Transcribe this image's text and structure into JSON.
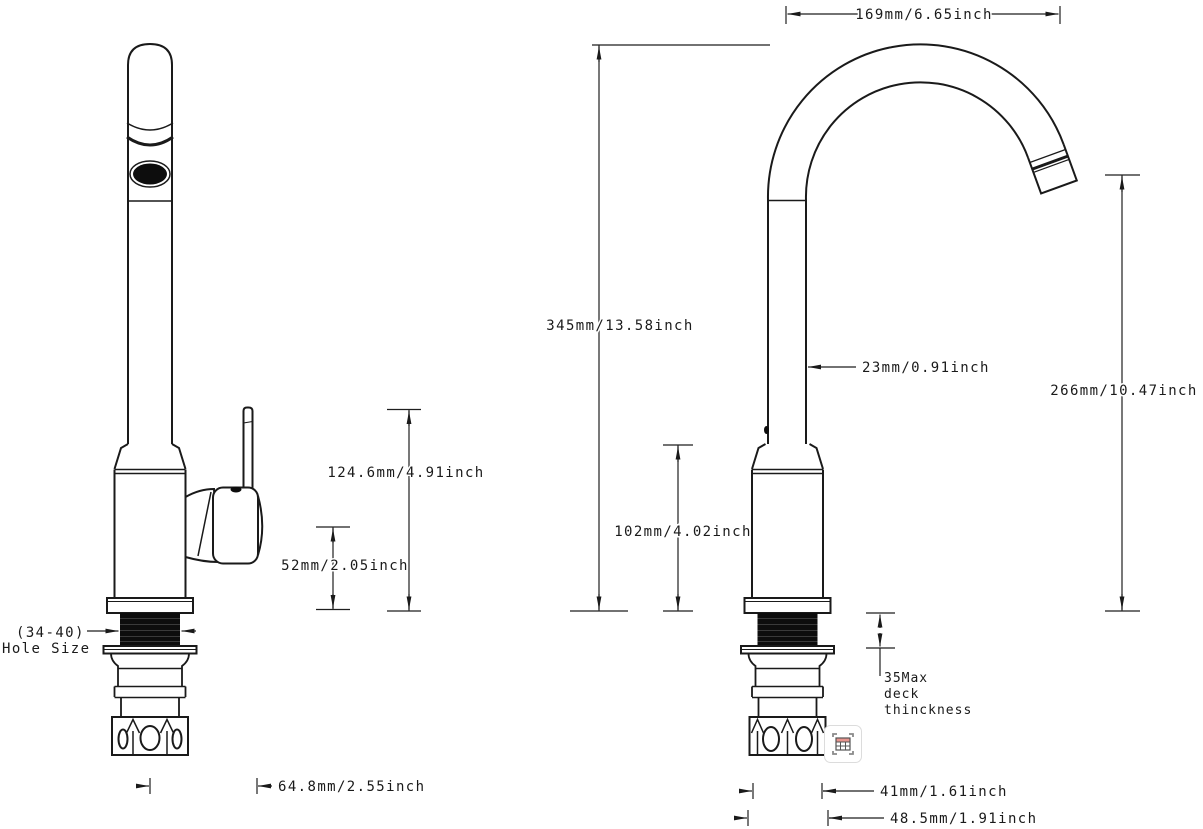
{
  "drawing": {
    "left_view": {
      "hole_size_line1": "(34-40)",
      "hole_size_line2": "Hole Size",
      "dim_handle_height": "124.6mm/4.91inch",
      "dim_valve_height": "52mm/2.05inch",
      "dim_spout_reach": "64.8mm/2.55inch"
    },
    "right_view": {
      "dim_spout_width": "169mm/6.65inch",
      "dim_overall_height": "345mm/13.58inch",
      "dim_tube_diameter": "23mm/0.91inch",
      "dim_outlet_height": "266mm/10.47inch",
      "dim_body_height": "102mm/4.02inch",
      "deck_note": [
        "35Max",
        "deck",
        "thinckness"
      ],
      "dim_nut_width": "41mm/1.61inch",
      "dim_base_width": "48.5mm/1.91inch"
    },
    "colors": {
      "line": "#1a1a1a",
      "fill_black": "#0d0d0d",
      "icon_accent": "#e8958e"
    }
  },
  "overlay": {
    "icon": "table-capture-icon"
  }
}
